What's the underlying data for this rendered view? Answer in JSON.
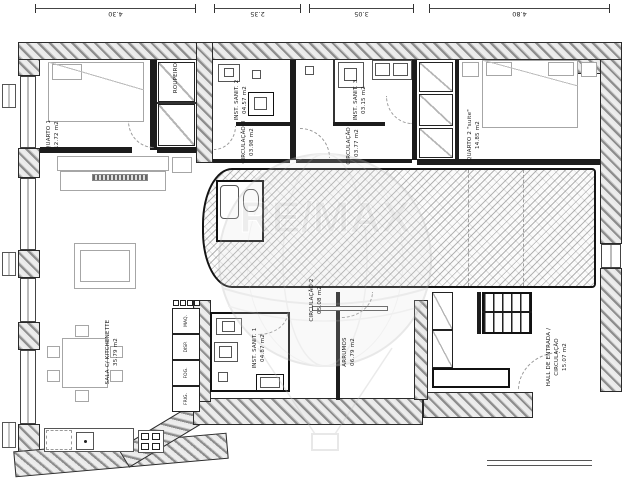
{
  "watermark": {
    "brand": "RE/MAX"
  },
  "dimensions": {
    "top": [
      "4.30",
      "2.35",
      "3.05",
      "4.80"
    ]
  },
  "rooms": {
    "quarto1": {
      "name": "QUARTO 1",
      "area": "12.72 m2"
    },
    "roupeiro": {
      "name": "ROUPEIRO"
    },
    "inst_sanit_2": {
      "name": "INST. SANIT. 2",
      "area": "04.57 m2"
    },
    "circulacao_3": {
      "name": "CIRCULAÇÃO 3",
      "area": "03.98 m2"
    },
    "inst_sanit_3": {
      "name": "INST. SANIT. 3",
      "area": "03.15 m2"
    },
    "circulacao_4": {
      "name": "CIRCULAÇÃO 4",
      "area": "03.77 m2"
    },
    "quarto2": {
      "name": "QUARTO 2 \"suite\"",
      "area": "14.85 m2"
    },
    "sala": {
      "name": "SALA C/ KITCHENETTE",
      "area": "35.79 m2"
    },
    "inst_sanit_1": {
      "name": "INST. SANIT. 1",
      "area": "04.87 m2"
    },
    "circulacao_2": {
      "name": "CIRCULAÇÃO 2",
      "area": "05.08 m2"
    },
    "arrumos": {
      "name": "ARRUMOS",
      "area": "06.79 m2"
    },
    "hall": {
      "name_line1": "HALL DE ENTRADA /",
      "name_line2": "CIRCULAÇÃO",
      "area": "15.07 m2"
    }
  },
  "appliances": [
    "MAQ.",
    "DISP.",
    "FOG.",
    "FRIG."
  ],
  "colors": {
    "line": "#1c1c1c",
    "wall_hatch": "#8d8d8d",
    "furniture": "#a6a6a6",
    "watermark": "#c9c9c9",
    "dashed": "#9a9a9a"
  }
}
